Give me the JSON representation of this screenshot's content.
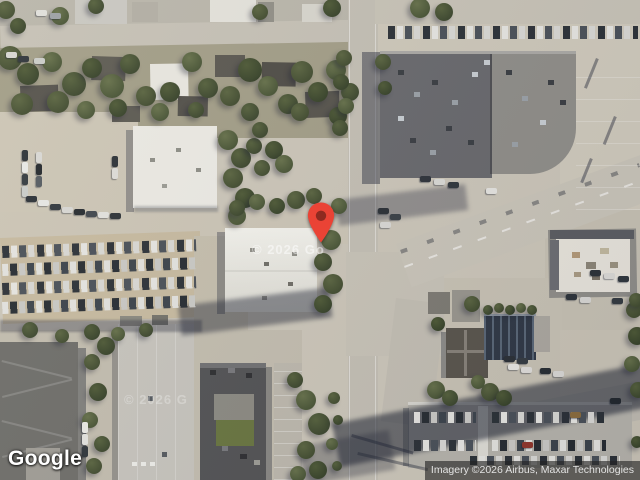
{
  "map": {
    "marker": {
      "fill": "#EA4335",
      "dot_fill": "#8E2A20"
    },
    "watermark_center": "© 2026 Go",
    "watermark_left": "© 2026 G"
  },
  "branding": {
    "logo_text": "Google"
  },
  "attribution": {
    "text": "Imagery ©2026 Airbus, Maxar Technologies"
  }
}
